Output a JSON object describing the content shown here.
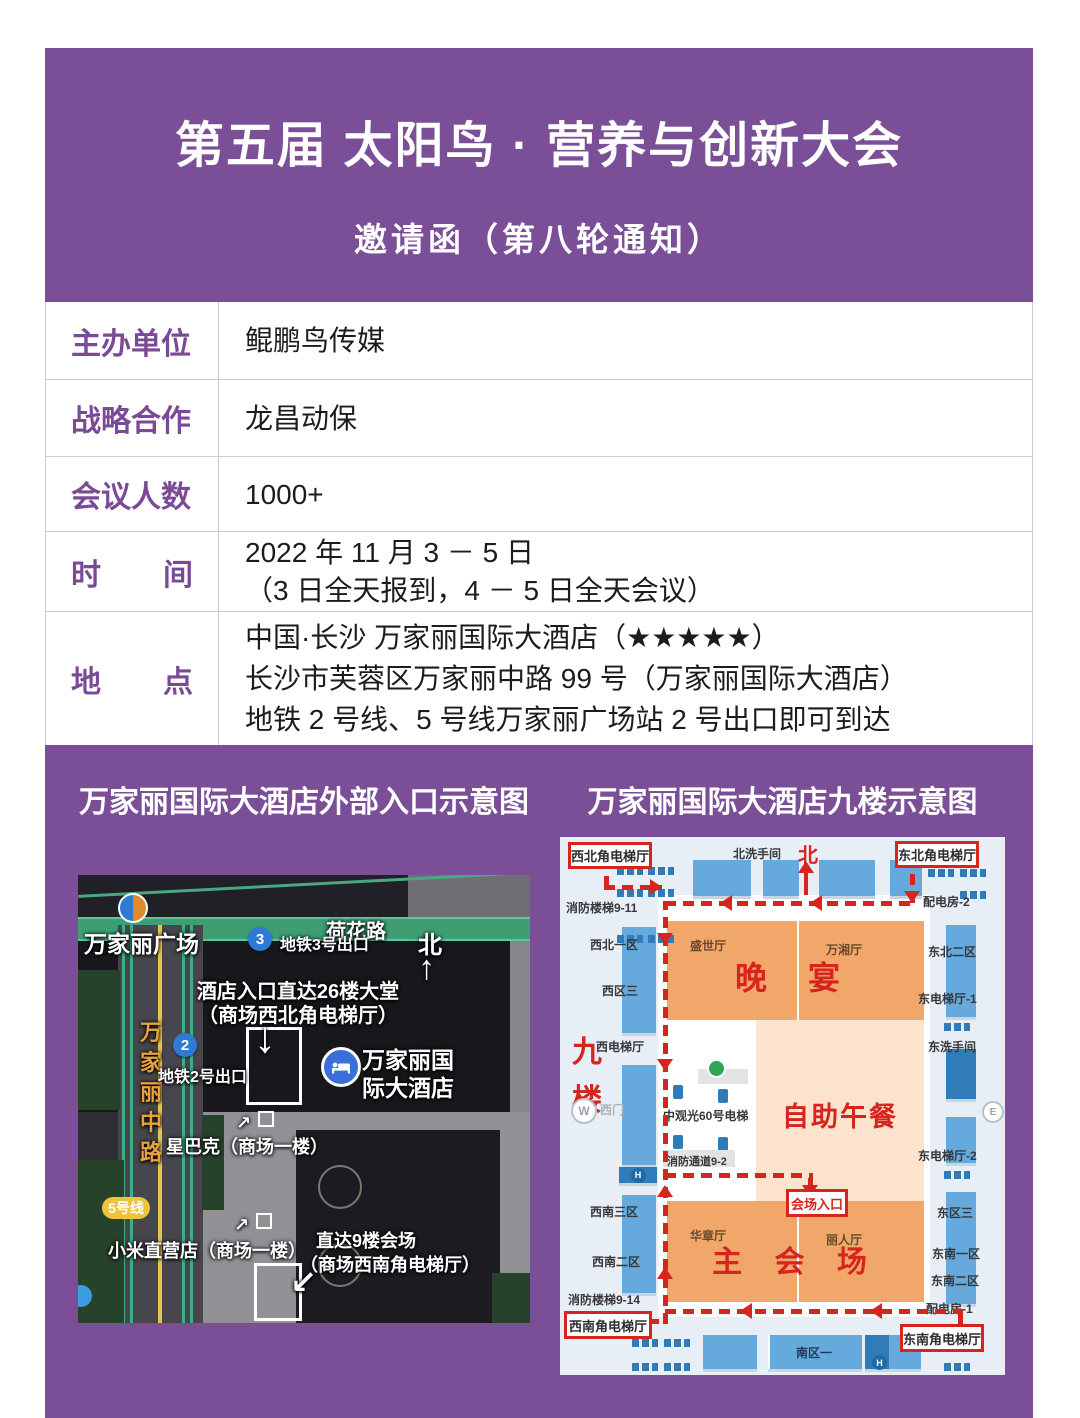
{
  "colors": {
    "purple": "#7b4f98",
    "red": "#d6251e",
    "orange": "#f2a76a",
    "peach": "#fbe3cd",
    "room_blue": "#66aadd",
    "dark_blue": "#2f7cb8",
    "metro_blue": "#2e7bd6",
    "line5_yellow": "#edc43c",
    "road_green": "#3f9d74"
  },
  "header": {
    "title": "第五届 太阳鸟 · 营养与创新大会",
    "subtitle": "邀请函（第八轮通知）"
  },
  "info": {
    "rows": [
      {
        "label": "主办单位",
        "lines": [
          "鲲鹏鸟传媒"
        ]
      },
      {
        "label": "战略合作",
        "lines": [
          "龙昌动保"
        ]
      },
      {
        "label": "会议人数",
        "lines": [
          "1000+"
        ]
      },
      {
        "label": "时间",
        "label_chars": [
          "时",
          "间"
        ],
        "lines": [
          "2022 年 11 月 3 － 5 日",
          "（3 日全天报到，4 － 5 日全天会议）"
        ]
      },
      {
        "label": "地点",
        "label_chars": [
          "地",
          "点"
        ],
        "lines": [
          "中国·长沙 万家丽国际大酒店（★★★★★）",
          "长沙市芙蓉区万家丽中路 99 号（万家丽国际大酒店）",
          "地铁 2 号线、5 号线万家丽广场站 2 号出口即可到达"
        ]
      }
    ]
  },
  "exterior": {
    "title": "万家丽国际大酒店外部入口示意图",
    "plaza": "万家丽广场",
    "road_top": "荷花路",
    "road_left": [
      "万",
      "家",
      "丽",
      "中",
      "路"
    ],
    "metro3_num": "3",
    "metro3_label": "地铁3号出口",
    "metro2_num": "2",
    "metro2_label": "地铁2号出口",
    "north_label": "北",
    "north_arrow": "↑",
    "entrance26_line1": "酒店入口直达26楼大堂",
    "entrance26_line2": "（商场西北角电梯厅）",
    "entrance26_arrow": "↓",
    "hotel_line1": "万家丽国",
    "hotel_line2": "际大酒店",
    "starbucks_label": "星巴克（商场一楼）",
    "starbucks_arrow": "↗",
    "line5_badge": "5号线",
    "xiaomi_label": "小米直营店（商场一楼）",
    "xiaomi_arrow": "↗",
    "entrance9_line1": "直达9楼会场",
    "entrance9_line2": "（商场西南角电梯厅）",
    "entrance9_arrow": "↙"
  },
  "floorplan": {
    "title": "万家丽国际大酒店九楼示意图",
    "nw_elevator": "西北角电梯厅",
    "ne_elevator": "东北角电梯厅",
    "sw_elevator": "西南角电梯厅",
    "se_elevator": "东南角电梯厅",
    "venue_entrance": "会场入口",
    "north_restroom": "北洗手间",
    "north": "北",
    "fire_stairs_911": "消防楼梯9-11",
    "power_room_2": "配电房-2",
    "nw_zone_1": "西北一区",
    "west_zone_3": "西区三",
    "ne_zone_2": "东北二区",
    "east_elevator_1": "东电梯厅-1",
    "hall_shengshi": "盛世厅",
    "hall_wanxiang": "万湘厅",
    "banquet": "晚 宴",
    "floor_char_1": "九",
    "floor_char_2": "楼",
    "west_elevator": "西电梯厅",
    "east_restroom": "东洗手间",
    "west_gate": "西门",
    "gate_w": "W",
    "gate_e": "E",
    "h_mark": "H",
    "sightseeing_elevator": "中观光60号电梯",
    "buffet_lunch": "自助午餐",
    "fire_passage_92": "消防通道9-2",
    "east_elevator_2": "东电梯厅-2",
    "sw_zone_3": "西南三区",
    "sw_zone_2": "西南二区",
    "hall_huazhang": "华章厅",
    "hall_liren": "丽人厅",
    "main_venue": "主 会 场",
    "east_zone_3": "东区三",
    "se_zone_1": "东南一区",
    "se_zone_2": "东南二区",
    "fire_stairs_914": "消防楼梯9-14",
    "power_room_1": "配电房-1",
    "south_zone_1": "南区一"
  }
}
